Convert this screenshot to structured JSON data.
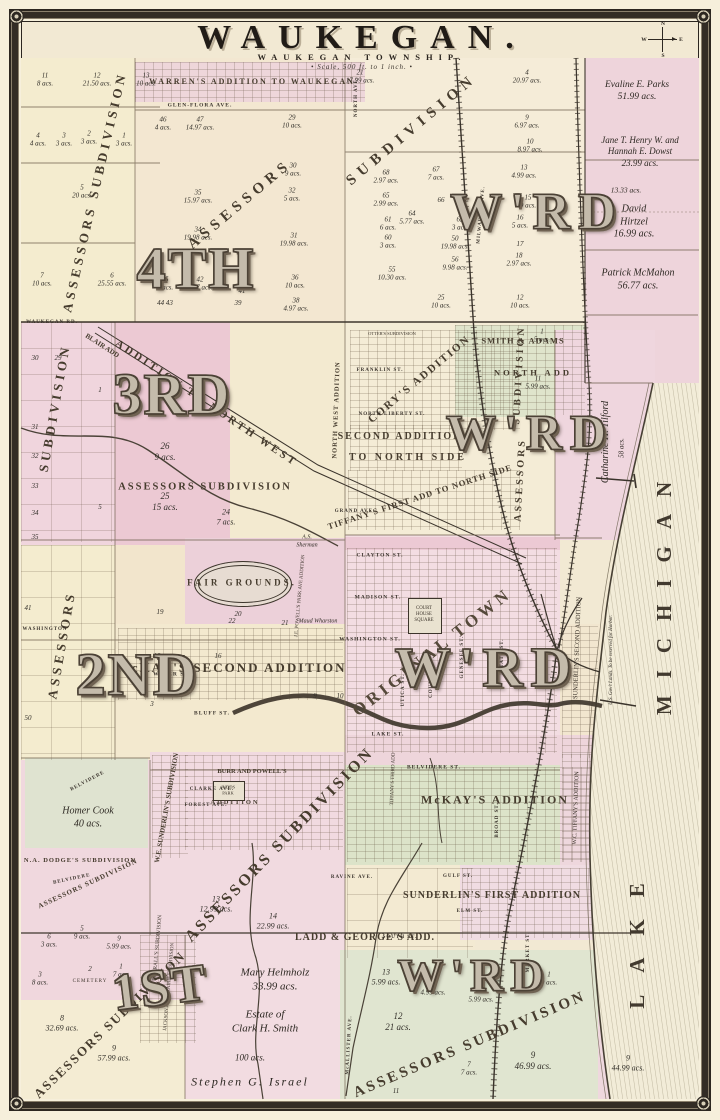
{
  "title": "WAUKEGAN.",
  "subtitle": "WAUKEGAN TOWNSHIP.",
  "scale_note": "• Scale, 500 ft. to 1 inch. •",
  "compass": {
    "n": "N",
    "e": "E",
    "s": "S",
    "w": "W"
  },
  "colors": {
    "paper": "#f2e9d3",
    "pink": "#eed4db",
    "rose": "#ecc9d4",
    "yellow": "#f4eccf",
    "green": "#dce3c9",
    "ink": "#3b332a"
  },
  "icons": {
    "corner_rosette": "radial-rosette",
    "compass_cross": "cross-with-cardinal-letters"
  },
  "lake": {
    "word1": "LAKE",
    "word2": "MICHIGAN",
    "us_lands": "U.S. Gov't Lands. To be reserved for Harbor."
  },
  "wards": {
    "fourth": "4TH",
    "fourth_wrd": "W'RD",
    "third": "3RD",
    "third_wrd": "W'RD",
    "second": "2ND",
    "second_wrd": "W'RD",
    "first": "1ST",
    "first_wrd": "W'RD"
  },
  "banners": {
    "top_assessors": "ASSESSORS",
    "top_subdivision": "SUBDIVISION",
    "nw_vert": "ASSESSORS SUBDIVISION",
    "left_sub": "SUBDIVISION",
    "left_assessors": "ASSESSORS",
    "mid_horizontal": "ASSESSORS SUBDIVISION",
    "right_sub": "SUBDIVISION",
    "right_assessors": "ASSESSORS",
    "center_diag": "ASSESSORS SUBDIVISION",
    "bl_small": "ASSESSORS SUBDIVISION",
    "bl_big": "ASSESSORS SUBDIVISION",
    "br_big": "ASSESSORS SUBDIVISION"
  },
  "additions": {
    "warrens": "WARREN'S ADDITION TO WAUKEGAN",
    "smith_adams": "SMITH & ADAMS",
    "north_add": "NORTH ADD",
    "blair": "BLAIR ADD",
    "nw_addition": "ADDITION TO NORTH WEST",
    "nw_vert": "NORTH WEST ADDITION",
    "corys": "CORY'S ADDITION",
    "otters": "OTTER'S SUBDIVISION",
    "second_north": "SECOND ADDITION",
    "to_north_side": "TO NORTH SIDE",
    "tiffanys_first": "TIFFANY'S FIRST ADD TO NORTH SIDE",
    "original_town": "ORIGINAL TOWN",
    "mckays_second": "McKAY'S SECOND ADDITION",
    "mckays": "McKAY'S ADDITION",
    "sunderlins_first": "SUNDERLIN'S FIRST ADDITION",
    "sunderlins_second": "SUNDERLIN'S SECOND ADDITION",
    "ladd_georges": "LADD & GEORGE'S\nADD.",
    "burr_powells": "BURR AND POWELL'S",
    "burr_powells2": "ADDITION",
    "judds_park": "JUDDS\nPARK",
    "na_dodges": "N.A. DODGE'S SUBDIVISION",
    "we_sunderlins": "W.E. SUNDERLIN'S SUBDIVISION",
    "burralls": "BURRALL'S SUBDIVISION",
    "wc_tiffanys": "W.C. TIFFANY'S ADDITION",
    "jackson_prairie": "JACKSON AND PRAIRIE SUBDIVISION",
    "tiffanys_third": "TIFFANY'S THIRD ADD",
    "jep_powells": "J.E. POWELL'S PARK AVE ADDITION",
    "cemetery": "CEMETERY",
    "court_house": "COURT\nHOUSE\nSQUARE",
    "fair_grounds": "FAIR\nGROUNDS."
  },
  "owners": {
    "parks": "Evaline E. Parks\n51.99 acs.",
    "dowst": "Jane T. Henry W. and\nHannah E. Dowst\n23.99 acs.",
    "hirtzel_extra": "13.33 acs.",
    "hirtzel": "David\nHirtzel\n16.99 acs.",
    "mcmahon": "Patrick McMahon\n56.77 acs.",
    "tilford": "Catharine H. Tilford",
    "tilford_acres": "58 acs.",
    "cook": "Homer Cook\n40 acs.",
    "sherman": "A.S.\nSherman",
    "wharston": "Maud Wharston",
    "helmholz": "Mary Helmholz\n33.99 acs.",
    "smith": "Estate of\nClark H. Smith",
    "israel_acres": "100 acs.",
    "israel": "Stephen G. Israel"
  },
  "streets": {
    "glen_flora": "GLEN-FLORA AVE.",
    "north_ave": "NORTH AVE.",
    "milwaukee": "MILWAUKEE AVE.",
    "waukegan_rd": "WAUKEGAN RD.",
    "grand": "GRAND AVE.",
    "franklin": "FRANKLIN ST.",
    "north_liberty": "NORTH LIBERTY ST.",
    "clayton": "CLAYTON ST.",
    "madison": "MADISON ST.",
    "washington": "WASHINGTON ST.",
    "washington_w": "WASHINGTON",
    "water": "WATER ST.",
    "bluff": "BLUFF ST.",
    "lake_st": "LAKE ST.",
    "utica": "UTICA ST.",
    "county": "COUNTY ST.",
    "genesee": "GENESEE ST.",
    "state": "STATE ST.",
    "belvidere": "BELVIDERE ST.",
    "belvidere_rd": "BELVIDERE",
    "belvidere_rd2": "BELVIDERE",
    "clarke": "CLARKE AVE.",
    "forest": "FOREST AVE.",
    "ravine": "RAVINE AVE.",
    "gulf": "GULF ST.",
    "elm": "ELM ST.",
    "south": "SOUTH ST.",
    "broad": "BROAD ST.",
    "market": "MARKET ST.",
    "mcallister": "McALLISTER AVE."
  },
  "lots": [
    "11\n8 acs.",
    "12\n21.50 acs.",
    "13\n10 acs.",
    "4\n4 acs.",
    "3\n3 acs.",
    "2\n3 acs.",
    "1\n3 acs.",
    "5\n20 acs.",
    "7\n10 acs.",
    "6\n25.55 acs.",
    "46\n4 acs.",
    "47\n14.97 acs.",
    "29\n10 acs.",
    "21\n17.99 acs.",
    "4\n20.97 acs.",
    "35\n15.97 acs.",
    "30\n9 acs.",
    "9\n6.97 acs.",
    "34\n19.98 acs.",
    "32\n5 acs.",
    "10\n8.97 acs.",
    "31\n19.98 acs.",
    "13\n4.99 acs.",
    "15\n9 acs.",
    "68\n2.97 acs.",
    "67\n7 acs.",
    "65\n2.99 acs.",
    "66",
    "64\n5.77 acs.",
    "61\n6 acs.",
    "62\n3 acs.",
    "16\n5 acs.",
    "60\n3 acs.",
    "17",
    "36\n10 acs.",
    "45\n4 acs.",
    "42\n5.97 acs.",
    "41",
    "44 43",
    "39",
    "38\n4.97 acs.",
    "55\n10.30 acs.",
    "56\n9.98 acs.",
    "50\n19.98 acs.",
    "18\n2.97 acs.",
    "25\n10 acs.",
    "12\n10 acs.",
    "30",
    "29",
    "31",
    "32",
    "33",
    "34",
    "35",
    "1",
    "5",
    "26\n9 acs.",
    "25\n15 acs.",
    "24\n7 acs.",
    "1\n5 acs.",
    "11\n5.99 acs.",
    "41",
    "50",
    "19",
    "20",
    "22",
    "21",
    "18",
    "17",
    "16",
    "3",
    "4",
    "9",
    "10",
    "13\n12.99 acs.",
    "14\n22.99 acs.",
    "13\n5.99 acs.",
    "16\n4.99 acs.",
    "12\n21 acs.",
    "4\n5.99 acs.",
    "9\n46.99 acs.",
    "7\n7 acs.",
    "11",
    "1\n9 acs.",
    "2",
    "8\n32.69 acs.",
    "9\n57.99 acs.",
    "3\n8 acs.",
    "2",
    "1\n7 acs.",
    "9\n5.99 acs.",
    "5\n9 acs.",
    "6\n3 acs.",
    "9\n44.99 acs."
  ]
}
